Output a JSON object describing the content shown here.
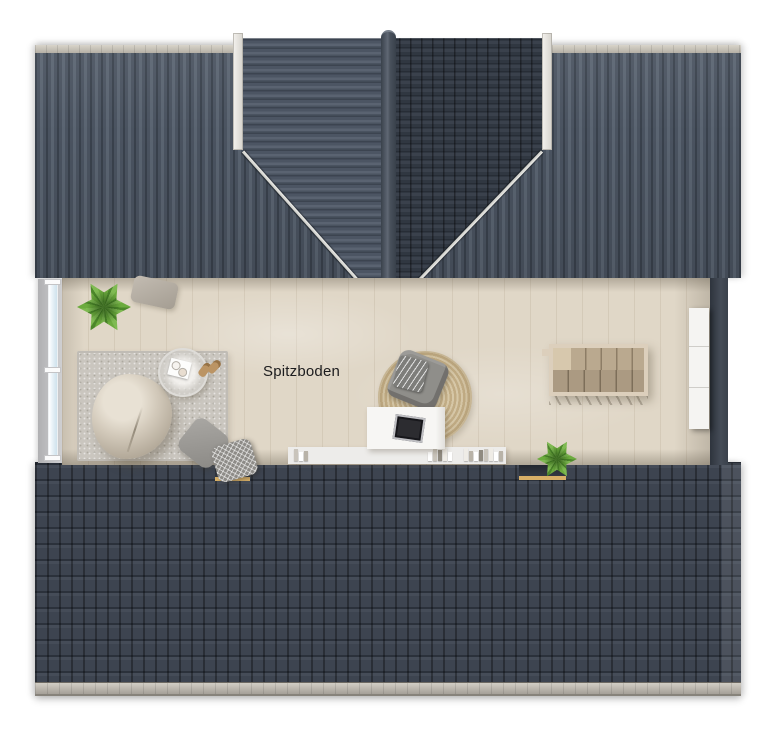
{
  "meta": {
    "type": "floor-plan-render",
    "floor": "attic"
  },
  "labels": {
    "room": "Spitzboden"
  },
  "colors": {
    "bg": "#ffffff",
    "roof-face": "#4a5360",
    "roof-highlight": "#5a6471",
    "tile-dark": "#343b45",
    "bottom-roof": "#3d4450",
    "trim-light": "#f4f2ee",
    "wood-floor": "#e0d7c7",
    "rug-gray": "#cac6bf",
    "jute": "#c1ac85",
    "stair-frame": "#dccfbc",
    "stair-wood": "#baa98f",
    "cabinet": "#f5f4f2",
    "wall-dark": "#3a414b",
    "glass": "#e2eef5",
    "sill-gold": "#d8b067",
    "plant": "#6cab3e",
    "text": "#1c1c1e"
  },
  "furniture": [
    {
      "name": "potted-plant-top-left"
    },
    {
      "name": "throw-pillow-top"
    },
    {
      "name": "area-rug"
    },
    {
      "name": "beanbag-chair"
    },
    {
      "name": "side-table-with-tray-and-cups"
    },
    {
      "name": "slippers"
    },
    {
      "name": "throw-pillow-gray"
    },
    {
      "name": "throw-pillow-zigzag"
    },
    {
      "name": "round-jute-rug"
    },
    {
      "name": "armchair-with-blanket"
    },
    {
      "name": "desk-with-laptop-tray"
    },
    {
      "name": "low-shelf-with-books"
    },
    {
      "name": "potted-plant-bottom"
    },
    {
      "name": "staircase-opening"
    },
    {
      "name": "storage-cabinet"
    }
  ],
  "structure": [
    {
      "name": "main-roof-standing-seam"
    },
    {
      "name": "cross-gable-dormer"
    },
    {
      "name": "gable-end-window-band"
    },
    {
      "name": "bottom-roof-tiles"
    },
    {
      "name": "roof-windows"
    },
    {
      "name": "gutter"
    }
  ]
}
